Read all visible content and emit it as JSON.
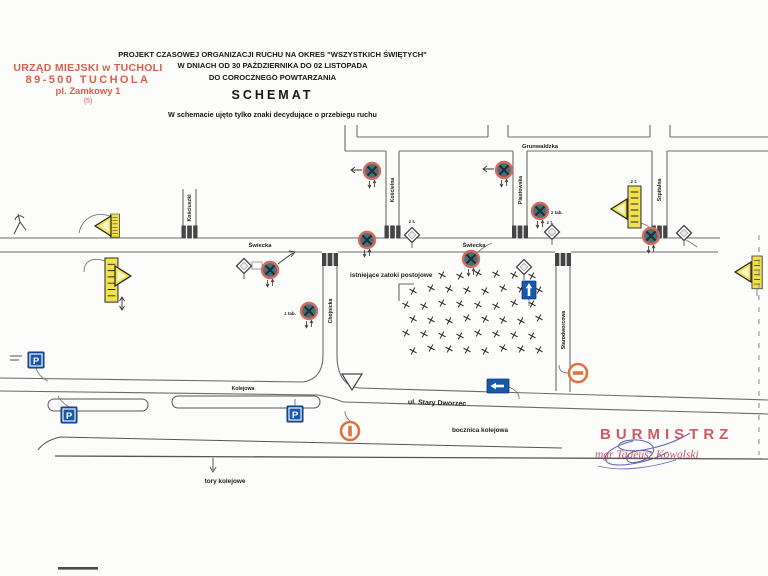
{
  "stamp": {
    "line1": "URZĄD MIEJSKI w TUCHOLI",
    "line2": "89-500 TUCHOLA",
    "line3": "pl. Zamkowy 1",
    "line4": "(5)",
    "color": "#d95f4b"
  },
  "title": {
    "line1": "PROJEKT CZASOWEJ ORGANIZACJI RUCHU NA OKRES \"WSZYSTKICH ŚWIĘTYCH\"",
    "line2": "W DNIACH OD 30 PAŹDZIERNIKA DO 02 LISTOPADA",
    "line3": "DO COROCZNEGO POWTARZANIA",
    "heading": "SCHEMAT",
    "note": "W schemacie ujęto tylko znaki decydujące o przebiegu ruchu"
  },
  "map": {
    "streets": {
      "grunwaldzka": "Grunwaldzka",
      "kosciuszki": "Kościuszki",
      "koscielna": "Kościelna",
      "piastowska": "Piastowska",
      "szpitalna": "Szpitalna",
      "swiecka": "Świecka",
      "chojnicka": "Chojnicka",
      "starodworcowa": "Starodworcowa",
      "kolejowa": "Kolejowa",
      "stary_dworzec": "ul. Stary Dworzec"
    },
    "annotations": {
      "parking_bays": "istniejące zatoki postojowe",
      "rail_siding": "bocznica kolejowa",
      "rail_tracks": "tory kolejowe",
      "plate_note": "z tab.",
      "plate_note_short": "z t."
    },
    "icons": {
      "no_stopping": "B-36 zakaz zatrzymywania",
      "parking_letter": "P",
      "priority_road": "D-1 droga z pierwszeństwem",
      "yield": "A-7 ustąp pierwszeństwa",
      "one_way": "D-3 droga jednokierunkowa",
      "no_entry": "B-2 zakaz wjazdu"
    },
    "colors": {
      "road": "#6b6b6b",
      "sign_blue": "#1758a8",
      "sign_yellow": "#f2e14e",
      "ring_red": "#d96a5a",
      "disc_teal": "#46707c",
      "orange": "#e0713e"
    }
  },
  "signature": {
    "role": "BURMISTRZ",
    "name": "mgr Tadeusz Kowalski",
    "role_color": "#cf5a66",
    "name_color": "#c8566e",
    "ink_color": "#5357a5"
  }
}
